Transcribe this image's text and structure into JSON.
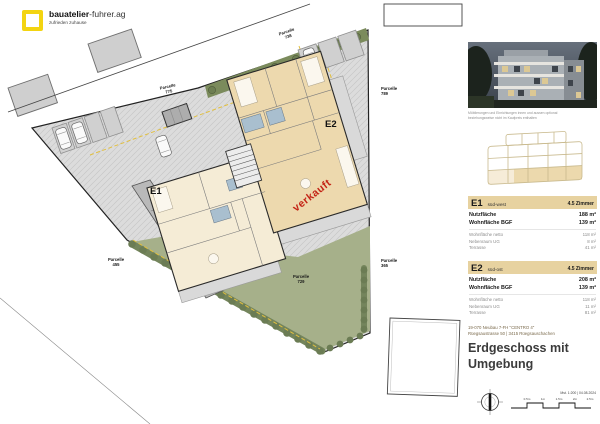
{
  "logo": {
    "brand_bold": "bauatelier",
    "brand_rest": "-fuhrer.ag",
    "tagline": "zufrieden zuhause"
  },
  "plan": {
    "sold": "verkauft",
    "parcels": [
      {
        "label": "Parcelle",
        "number": "738"
      },
      {
        "label": "Parcelle",
        "number": "775"
      },
      {
        "label": "Parcelle",
        "number": "789"
      },
      {
        "label": "Parcelle",
        "number": "455"
      },
      {
        "label": "Parcelle",
        "number": "729"
      },
      {
        "label": "Parcelle",
        "number": "365"
      }
    ]
  },
  "sidebar": {
    "photo_caption_line1": "Möblierungen und Einrichtungen innen und aussen optional",
    "photo_caption_line2": "beziehungsweise nicht im Kaufpreis enthalten",
    "units": [
      {
        "id": "E1",
        "orientation": "süd-west",
        "rooms": "4.5 Zimmer",
        "rows_bold": [
          {
            "label": "Nutzfläche",
            "value": "188 m²"
          },
          {
            "label": "Wohnfläche BGF",
            "value": "139 m²"
          }
        ],
        "rows_light": [
          {
            "label": "Wohnfläche netto",
            "value": "118 m²"
          },
          {
            "label": "Nebenraum UG",
            "value": "8 m²"
          },
          {
            "label": "Terrasse",
            "value": "41 m²"
          }
        ]
      },
      {
        "id": "E2",
        "orientation": "süd-ost",
        "rooms": "4.5 Zimmer",
        "rows_bold": [
          {
            "label": "Nutzfläche",
            "value": "208 m²"
          },
          {
            "label": "Wohnfläche BGF",
            "value": "139 m²"
          }
        ],
        "rows_light": [
          {
            "label": "Wohnfläche netto",
            "value": "118 m²"
          },
          {
            "label": "Nebenraum UG",
            "value": "11 m²"
          },
          {
            "label": "Terrasse",
            "value": "81 m²"
          }
        ]
      }
    ],
    "project": {
      "line1": "19-070 Neubau 7-FH \"CENTRO 4\"",
      "line2": "Rüegsaustrasse 50 | 3415 Rüegsauschachen"
    },
    "title_line1": "Erdgeschoss mit",
    "title_line2": "Umgebung",
    "scale": {
      "note": "Mst. 1:200 | 04.08.2024",
      "ticks": [
        "0.5m",
        "1m",
        "1.5m",
        "2m",
        "2.5m"
      ]
    }
  },
  "colors": {
    "accent_yellow": "#f3d411",
    "sold_red": "#c42416",
    "garden_green": "#a6b08a",
    "hedge_green": "#6b7c54",
    "room_beige": "#edd9ae",
    "panel_tan": "#e7d2a0"
  }
}
